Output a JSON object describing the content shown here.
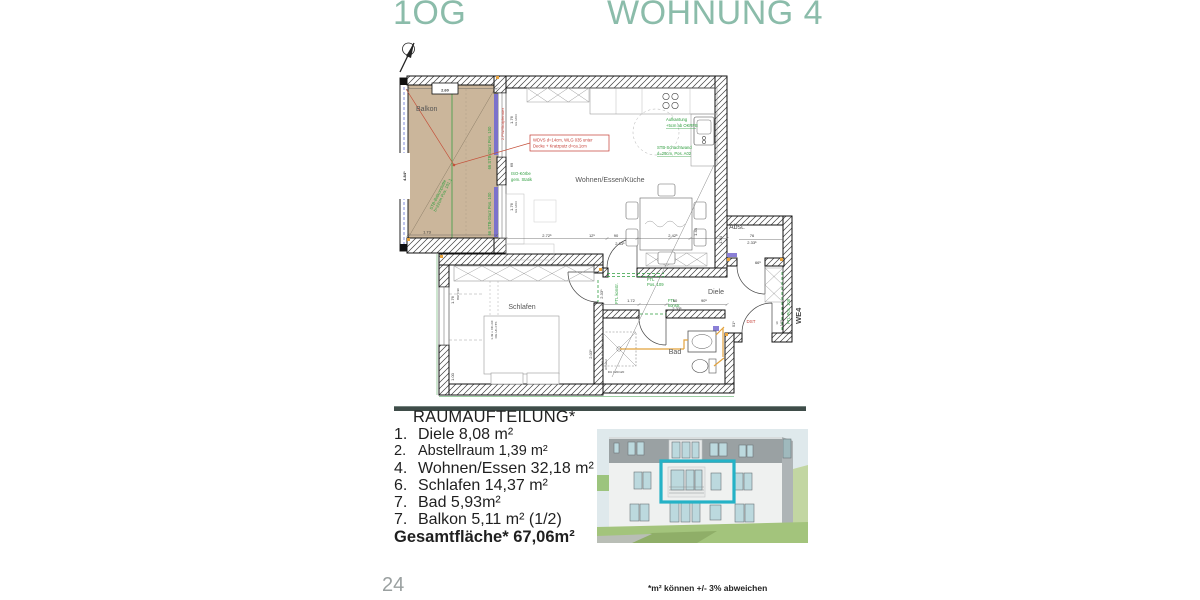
{
  "header": {
    "floor": "1OG",
    "apartment": "WOHNUNG 4",
    "accent_color": "#8bbcaa"
  },
  "plan": {
    "labels": {
      "balkon": "Balkon",
      "wohnen": "Wohnen/Essen/Küche",
      "schlafen": "Schlafen",
      "bad": "Bad",
      "diele": "Diele",
      "abst": "Abst."
    },
    "annotations": {
      "wdvs1": "WDVS d=14cm, WLG 035 unter",
      "wdvs2": "Decke + Kratzputz d=ca.1cm",
      "iso1": "ISO-Körbe",
      "iso2": "gem. Statik",
      "aufk1": "Aufkantung",
      "aufk2": "+5cm ab OKRFB",
      "schacht1": "STB-Schachtwand",
      "schacht2": "d=25cm, Pos. A02",
      "platte1": "STB-Balkonplatte",
      "platte2": "h=22cm Pos. 101.1",
      "sturz": "66 STB-Sturz Pos. 100",
      "fenster": "2.PW/Stülpfenster",
      "ftl109_1": "FTL",
      "ftl109_2": "Pos. 109",
      "ftlk1": "FTL",
      "ftlk2": "konstr.",
      "ftlk": "FTL konstr.",
      "ftl108": "FTL Pos. 108",
      "dst": "DST",
      "we4": "WE4",
      "armatur": "Armatur",
      "du": "DU 120/120",
      "brh": "BRH=90",
      "okrf": "1.49 v. OK-RF",
      "ukfts": "OG UK-FTS"
    },
    "dims": {
      "d260": "2.60",
      "d484": "4.84⁵",
      "d173": "1.73",
      "d272": "2.72⁵",
      "d12": "12⁵",
      "d90": "90",
      "d233": "2.33⁵",
      "d242": "2.42⁵",
      "d144": "1.44",
      "d176": "1.76",
      "dukd": "bis UKD",
      "d69": "69",
      "d172": "1.72",
      "d905": "90⁵",
      "d203": "2.03⁵",
      "d100": "1.00",
      "d76": "76",
      "d665": "66⁵",
      "d101": "1.01",
      "d10": "10",
      "d51": "51⁵"
    }
  },
  "room_list": {
    "title": "RAUMAUFTEILUNG*",
    "items": [
      {
        "no": "1.",
        "name": "Diele",
        "area": "8,08 m²"
      },
      {
        "no": "2.",
        "name": "Abstellraum",
        "area": "1,39 m²"
      },
      {
        "no": "4.",
        "name": "Wohnen/Essen",
        "area": "32,18 m²"
      },
      {
        "no": "6.",
        "name": "Schlafen",
        "area": "14,37 m²"
      },
      {
        "no": "7.",
        "name": "Bad",
        "area": "5,93m²"
      },
      {
        "no": "7.",
        "name": "Balkon",
        "area": "5,11 m² (1/2)"
      }
    ],
    "total_label": "Gesamtfläche*",
    "total_value": "67,06m²"
  },
  "facade": {
    "highlight_color": "#25b2c6"
  },
  "footer": {
    "page_number": "24",
    "note": "*m² können +/- 3% abweichen"
  }
}
